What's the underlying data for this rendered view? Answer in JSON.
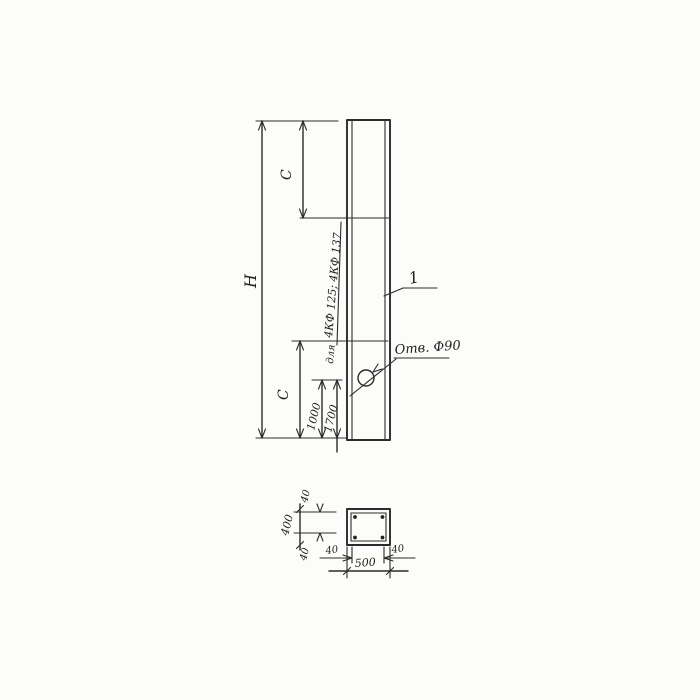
{
  "drawing": {
    "elevation": {
      "height_label": "H",
      "c_top_label": "C",
      "c_bottom_label": "C",
      "dim_1000": "1000",
      "dim_1700": "1700",
      "note_prefix": "для",
      "note_types": "4КФ 125; 4КФ 137",
      "hole_label": "Отв. Ф90",
      "item_number": "1"
    },
    "section": {
      "width_total": "500",
      "height_total": "400",
      "cover_top": "40",
      "cover_bottom": "40",
      "cover_left": "40",
      "cover_right": "40"
    }
  }
}
